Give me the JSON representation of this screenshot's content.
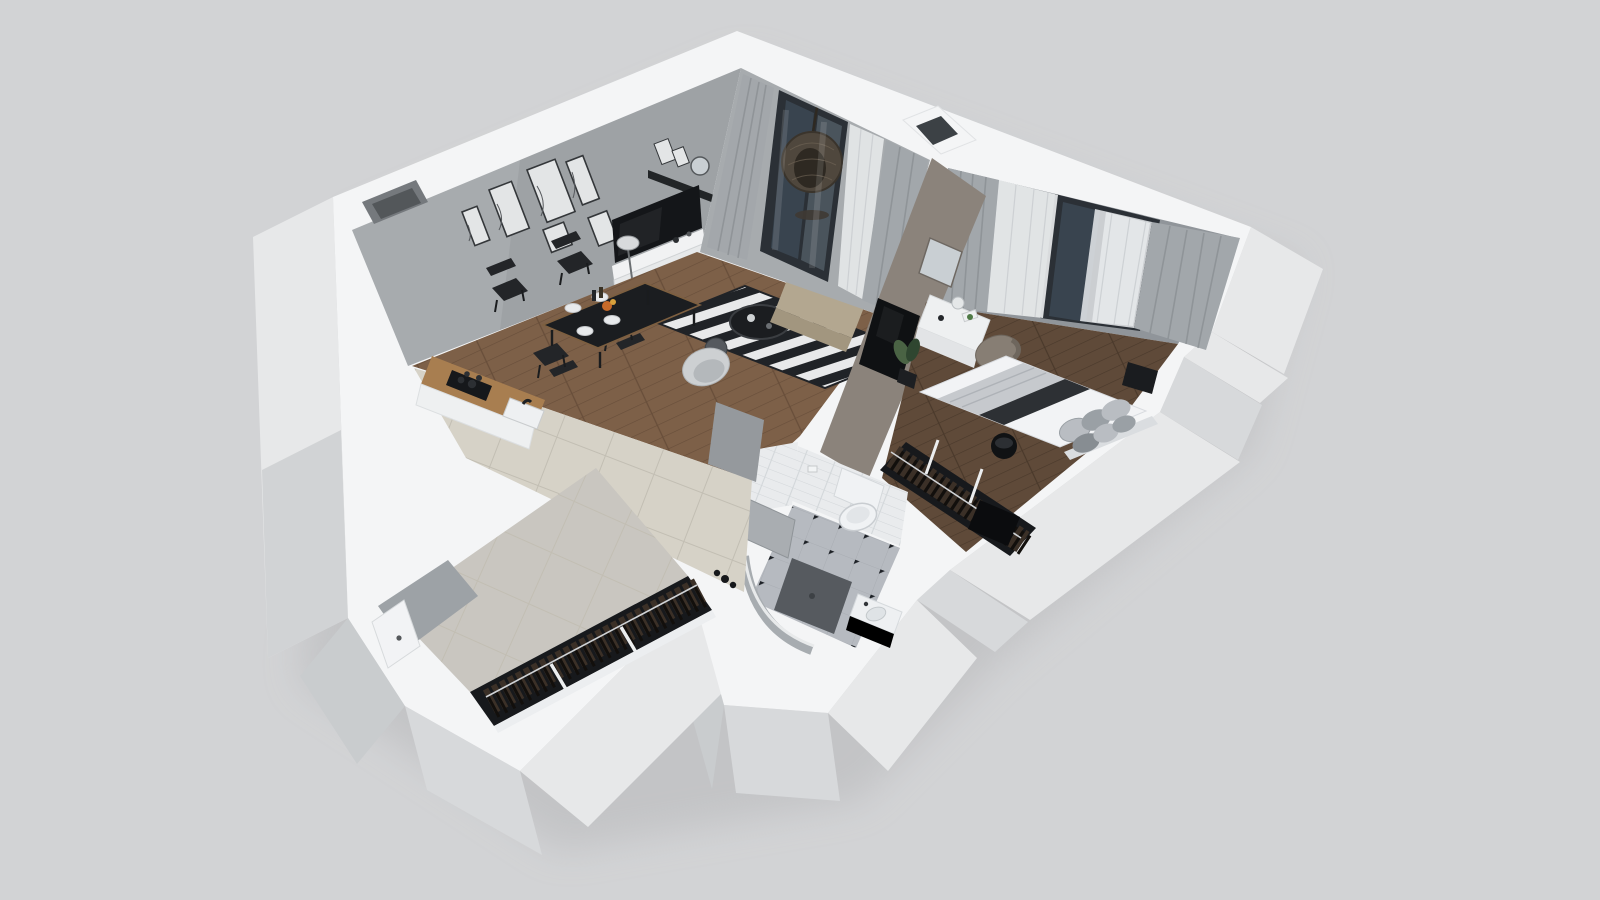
{
  "app": {
    "title": "3D dollhouse floor plan render — one-bedroom apartment",
    "view": "top-down cutaway perspective",
    "visible_text": ""
  },
  "palette": {
    "bg": "#d2d3d5",
    "bldg_shadow": "#b7b8ba",
    "wall_top": "#f4f5f6",
    "band_edge": "#e1e3e5",
    "face_light": "#e7e8e9",
    "face_mid": "#d7d9db",
    "face_dim": "#c9ccce",
    "face_dark": "#bfc2c4",
    "int_wall": "#a7abae",
    "int_wall_dark": "#90949880",
    "bedroom_wall": "#90959a",
    "taupe_wall": "#8b837b",
    "wood_living": "#7d6048",
    "wood_living_line": "#684e3a",
    "wood_bed": "#5f4a39",
    "wood_bed_line": "#4a392b",
    "tile_floor": "#d6d2c7",
    "tile_grout": "#c2beb3",
    "tile_corridor": "#c9c6c0",
    "rug_black": "#202327",
    "rug_white": "#e8e9ea",
    "sofa": "#b3a790",
    "sofa_light": "#c1b59e",
    "sofa_dark": "#a2967f",
    "tub_chair": "#cdd0d2",
    "tub_chair_inner": "#b4b8bb",
    "tv_black": "#141619",
    "panel_black": "#0f1113",
    "shelf_black": "#222527",
    "stand_white": "#f1f2f3",
    "stand_front": "#e7e9ea",
    "table_black": "#1b1d20",
    "chair_black": "#232528",
    "counter_wood": "#a87e50",
    "cooktop_black": "#16181b",
    "sink_white": "#eef0f2",
    "curtain_gray": "#a2a7ab",
    "curtain_fold": "#8b9094",
    "sheer_white": "#e8eaec",
    "frame_dark": "#2b3036",
    "glass": "#c9ced2",
    "glass_dark": "#39444f",
    "egg_chair": "#4f473d",
    "egg_dark": "#2e2922",
    "plant_green": "#4a6344",
    "plant_green_dark": "#2f4630",
    "pot_black": "#1d1f22",
    "bed_white": "#f2f3f5",
    "bed_throw": "#c6c9cd",
    "bed_runner": "#2d3034",
    "pillow_a": "#9aa0a5",
    "pillow_b": "#b9bdc2",
    "pillow_c": "#878d92",
    "desk_white": "#eef0f1",
    "chair_taupe": "#877e74",
    "mirror_glass": "#c9cfd3",
    "rack_dark": "#17191c",
    "clothes_a": "#3b3027",
    "clothes_b": "#120f0c",
    "rail_metal": "#cfd2d5",
    "bath_tile": "#e9ebed",
    "bath_tile_line": "#d3d7da",
    "bath_floor": "#b6bac0",
    "bath_diamond": "#1d2126",
    "shower_floor": "#565a5f",
    "toilet_white": "#f0f2f4",
    "door_white": "#f2f3f5",
    "door_gray": "#a9adb1",
    "shaft_dark": "#53575a",
    "shaft_mid": "#75797d",
    "black_mirror": "#0b0c0e",
    "nightstand_black": "#1a1c1f",
    "frame_print": "#e3e5e6",
    "art_line": "#55585c",
    "accent_orange": "#c66a2a",
    "tray_green": "#4f7a46"
  },
  "scene": {
    "rooms": [
      {
        "name": "living-room",
        "floor": "wood-plank",
        "objects": [
          "gallery-wall-frames",
          "floating-shelf",
          "wall-mounted-tv",
          "tv-stand",
          "floor-lamp",
          "dining-table",
          "dining-chairs",
          "striped-rug",
          "coffee-table",
          "drum-stool",
          "armchair-sofa",
          "tub-chair-near-rug",
          "tub-chair-near-hall",
          "potted-palm"
        ]
      },
      {
        "name": "kitchen",
        "floor": "ceramic-tile",
        "objects": [
          "wood-counter",
          "cooktop",
          "sink-with-faucet"
        ]
      },
      {
        "name": "balcony",
        "objects": [
          "sliding-glass-door",
          "hanging-egg-chair"
        ]
      },
      {
        "name": "bedroom",
        "floor": "wood-plank-dark",
        "objects": [
          "window-with-sheers",
          "gray-curtains",
          "double-bed",
          "bed-pillows",
          "bed-runner",
          "vanity-desk",
          "desk-chair",
          "wall-mirror",
          "wall-tv-panel",
          "open-clothes-rack",
          "nightstand",
          "floor-pot",
          "potted-plant",
          "dark-wall-mirror"
        ]
      },
      {
        "name": "bathroom",
        "floor": "checkered-tile",
        "objects": [
          "subway-tile-walls",
          "wall-hung-toilet",
          "toilet-paper-holder",
          "walk-in-shower",
          "vanity-sink",
          "open-door"
        ]
      },
      {
        "name": "hallway",
        "floor": "ceramic-tile",
        "objects": [
          "floor-vases"
        ]
      },
      {
        "name": "entry-corridor",
        "floor": "ceramic-tile",
        "objects": [
          "open-wardrobe-with-clothes",
          "entrance-door"
        ]
      }
    ],
    "counts": {
      "gallery_frames": 6,
      "shelf_frames": 2,
      "dining_chairs": 4,
      "bed_pillows": 6,
      "wardrobe_sections": 3,
      "bedroom_rack_sections": 2,
      "window_openings": 2,
      "wall_shafts": 2
    }
  }
}
